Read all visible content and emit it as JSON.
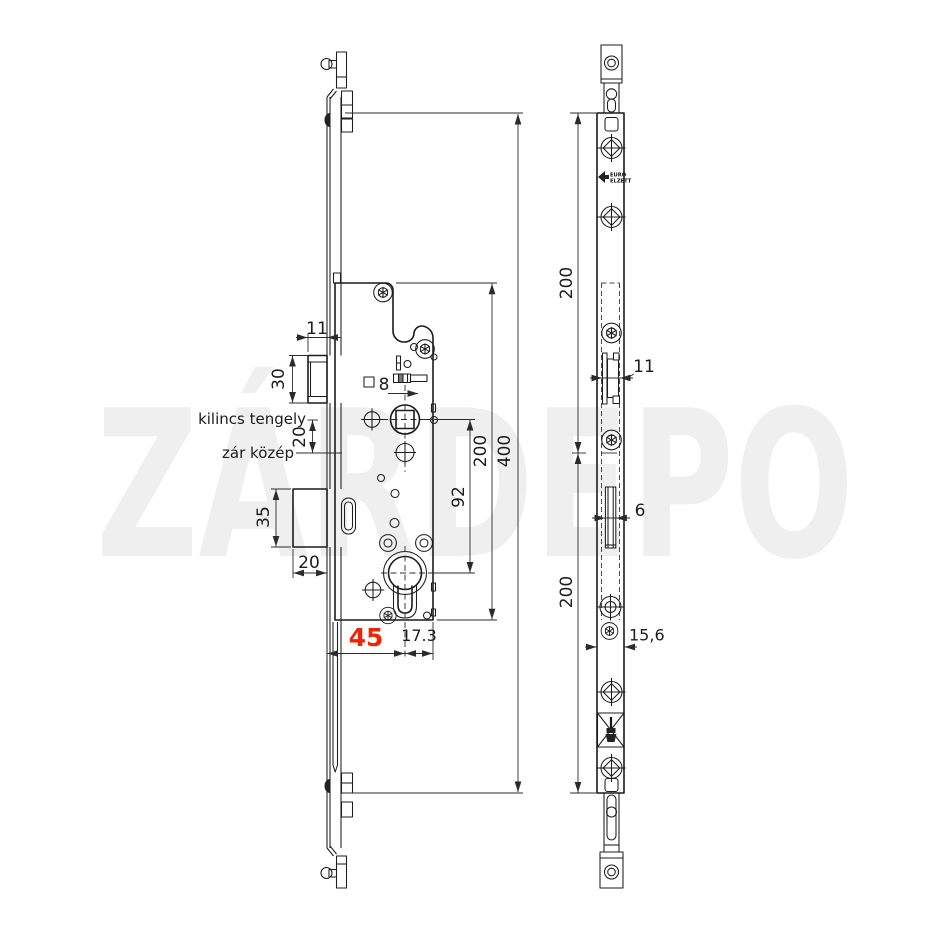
{
  "watermark": {
    "text": "ZÁRDEPO"
  },
  "colors": {
    "line": "#1c1c1c",
    "dimension": "#2b2b2b",
    "highlight_red": "#ee2505",
    "watermark_gray": "#efefef"
  },
  "left_view": {
    "labels": {
      "handle_axis": "kilincs tengely",
      "lock_center": "zár közép"
    },
    "dims": {
      "latch_protrusion": "11",
      "latch_height": "30",
      "handle_to_center": "20",
      "deadbolt_height": "35",
      "deadbolt_throw": "20",
      "backset": "45",
      "cylinder_to_edge": "17.3",
      "spindle_square": "8",
      "handle_to_cylinder": "92",
      "case_height": "200",
      "total_height": "400"
    }
  },
  "right_view": {
    "dims": {
      "upper_section": "200",
      "latch_width": "11",
      "bolt_width": "6",
      "lower_section": "200",
      "faceplate_width": "15,6"
    },
    "logo": {
      "brand_line1": "EURO",
      "brand_line2": "ELZETT"
    }
  }
}
